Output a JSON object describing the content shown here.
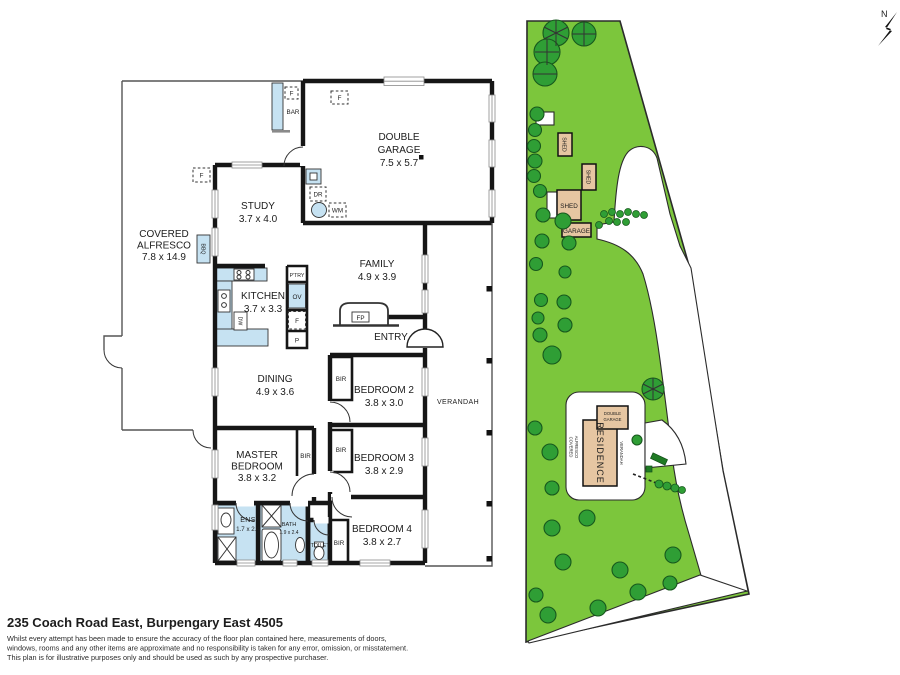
{
  "page": {
    "address": "235 Coach Road East, Burpengary East 4505",
    "disclaimer": [
      "Whilst every attempt has been made to ensure the accuracy of the floor plan contained here, measurements of doors,",
      "windows, rooms and any other items are approximate and no responsibility is taken for any error, omission, or misstatement.",
      "This plan is for illustrative purposes only and should be used as such by any prospective purchaser."
    ]
  },
  "compass": {
    "north": "N"
  },
  "floorplan": {
    "rooms": {
      "garage": {
        "name": [
          "DOUBLE",
          "GARAGE"
        ],
        "dims": "7.5 x 5.7"
      },
      "study": {
        "name": [
          "STUDY"
        ],
        "dims": "3.7 x 4.0"
      },
      "alfresco": {
        "name": [
          "COVERED",
          "ALFRESCO"
        ],
        "dims": "7.8 x 14.9"
      },
      "kitchen": {
        "name": [
          "KITCHEN"
        ],
        "dims": "3.7 x 3.3"
      },
      "family": {
        "name": [
          "FAMILY"
        ],
        "dims": "4.9 x 3.9"
      },
      "dining": {
        "name": [
          "DINING"
        ],
        "dims": "4.9 x 3.6"
      },
      "master": {
        "name": [
          "MASTER",
          "BEDROOM"
        ],
        "dims": "3.8 x 3.2"
      },
      "bed2": {
        "name": [
          "BEDROOM 2"
        ],
        "dims": "3.8 x 3.0"
      },
      "bed3": {
        "name": [
          "BEDROOM 3"
        ],
        "dims": "3.8 x 2.9"
      },
      "bed4": {
        "name": [
          "BEDROOM 4"
        ],
        "dims": "3.8 x 2.7"
      },
      "ens": {
        "name": [
          "ENS"
        ],
        "dims": "1.7 x 2.4"
      },
      "bath": {
        "name": [
          "BATH"
        ],
        "dims": "1.9 x 2.4"
      }
    },
    "labels": {
      "entry": "ENTRY",
      "verandah": "VERANDAH",
      "toilet": "TOILET",
      "bar": "BAR",
      "bbq": "BBQ",
      "bir": "BIR",
      "fp": "FP",
      "ptry": "P'TRY",
      "ov": "OV",
      "pantry_p": "P",
      "fridge": "F",
      "dr": "DR",
      "wm": "WM",
      "dw": "DW"
    }
  },
  "siteplan": {
    "labels": {
      "shed": "SHED",
      "garage": "GARAGE",
      "residence": "RESIDENCE",
      "double_garage": [
        "DOUBLE",
        "GARAGE"
      ],
      "verandah": "VERANDAH",
      "covered_alfresco": [
        "COVERED",
        "ALFRESCO"
      ]
    }
  },
  "colors": {
    "lawn": "#7cc63c",
    "tree": "#2f9e35",
    "tree_outline": "#17581d",
    "shed_fill": "#e6c6a2",
    "fixture_blue": "#c6e2f2",
    "wall": "#161616"
  }
}
